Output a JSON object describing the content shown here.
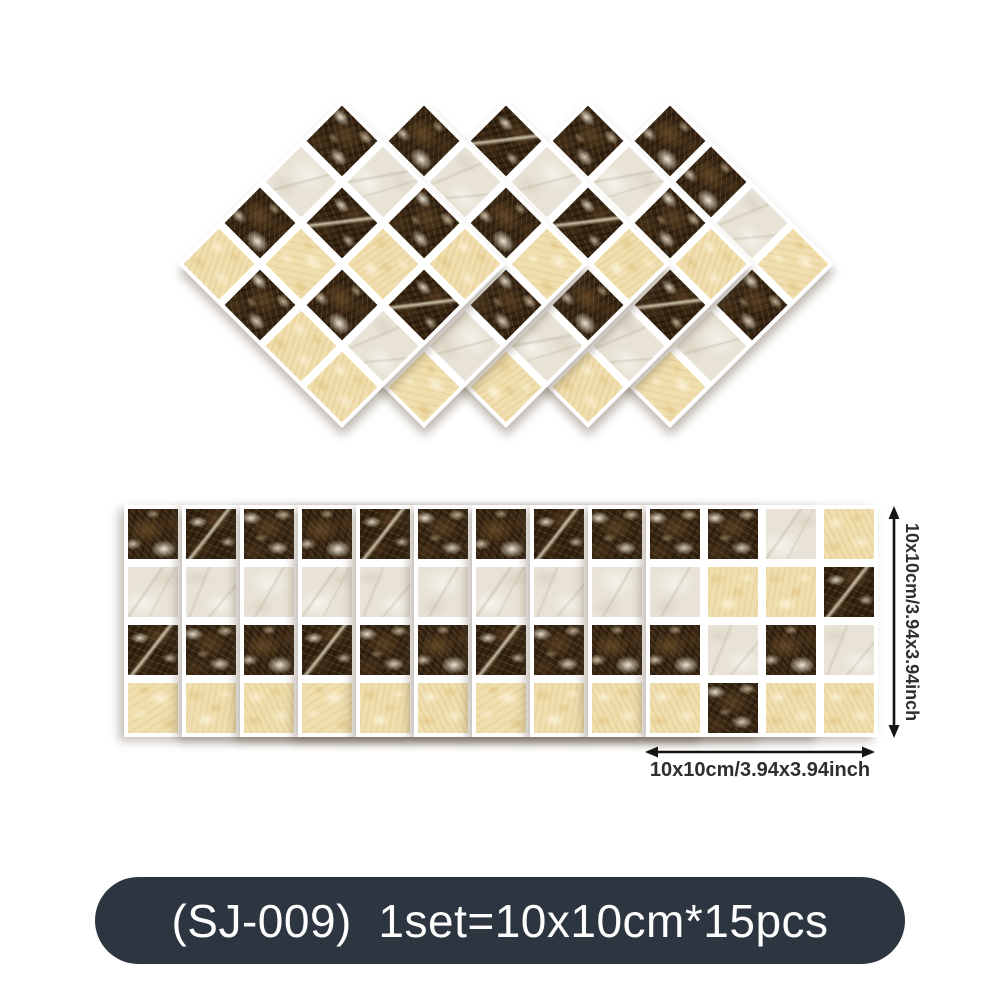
{
  "product": {
    "badge_text": "(SJ-009)  1set=10x10cm*15pcs",
    "badge_color": "#2d3640",
    "badge_text_color": "#fdfdfd"
  },
  "dimensions": {
    "width_label": "10x10cm/3.94x3.94inch",
    "height_label": "10x10cm/3.94x3.94inch",
    "arrow_color": "#141414"
  },
  "mosaic": {
    "tile_colors": {
      "dark": "#362410",
      "cream": "#e8e3d6",
      "beige": "#f0dfae"
    },
    "sheet_background": "#ffffff",
    "diamond_sheet_count": 5,
    "strip_covered_sheet_count": 9,
    "strip_total_sheet_count": 10,
    "standard_pattern": [
      [
        "dark",
        "cream",
        "dark",
        "beige"
      ],
      [
        "cream",
        "dark",
        "beige",
        "dark"
      ],
      [
        "dark",
        "beige",
        "dark",
        "cream"
      ],
      [
        "beige",
        "dark",
        "beige",
        "beige"
      ]
    ],
    "mixed_pattern": [
      [
        "dark",
        "dark",
        "cream",
        "beige"
      ],
      [
        "cream",
        "beige",
        "beige",
        "dark"
      ],
      [
        "dark",
        "cream",
        "dark",
        "cream"
      ],
      [
        "beige",
        "dark",
        "beige",
        "beige"
      ]
    ]
  }
}
